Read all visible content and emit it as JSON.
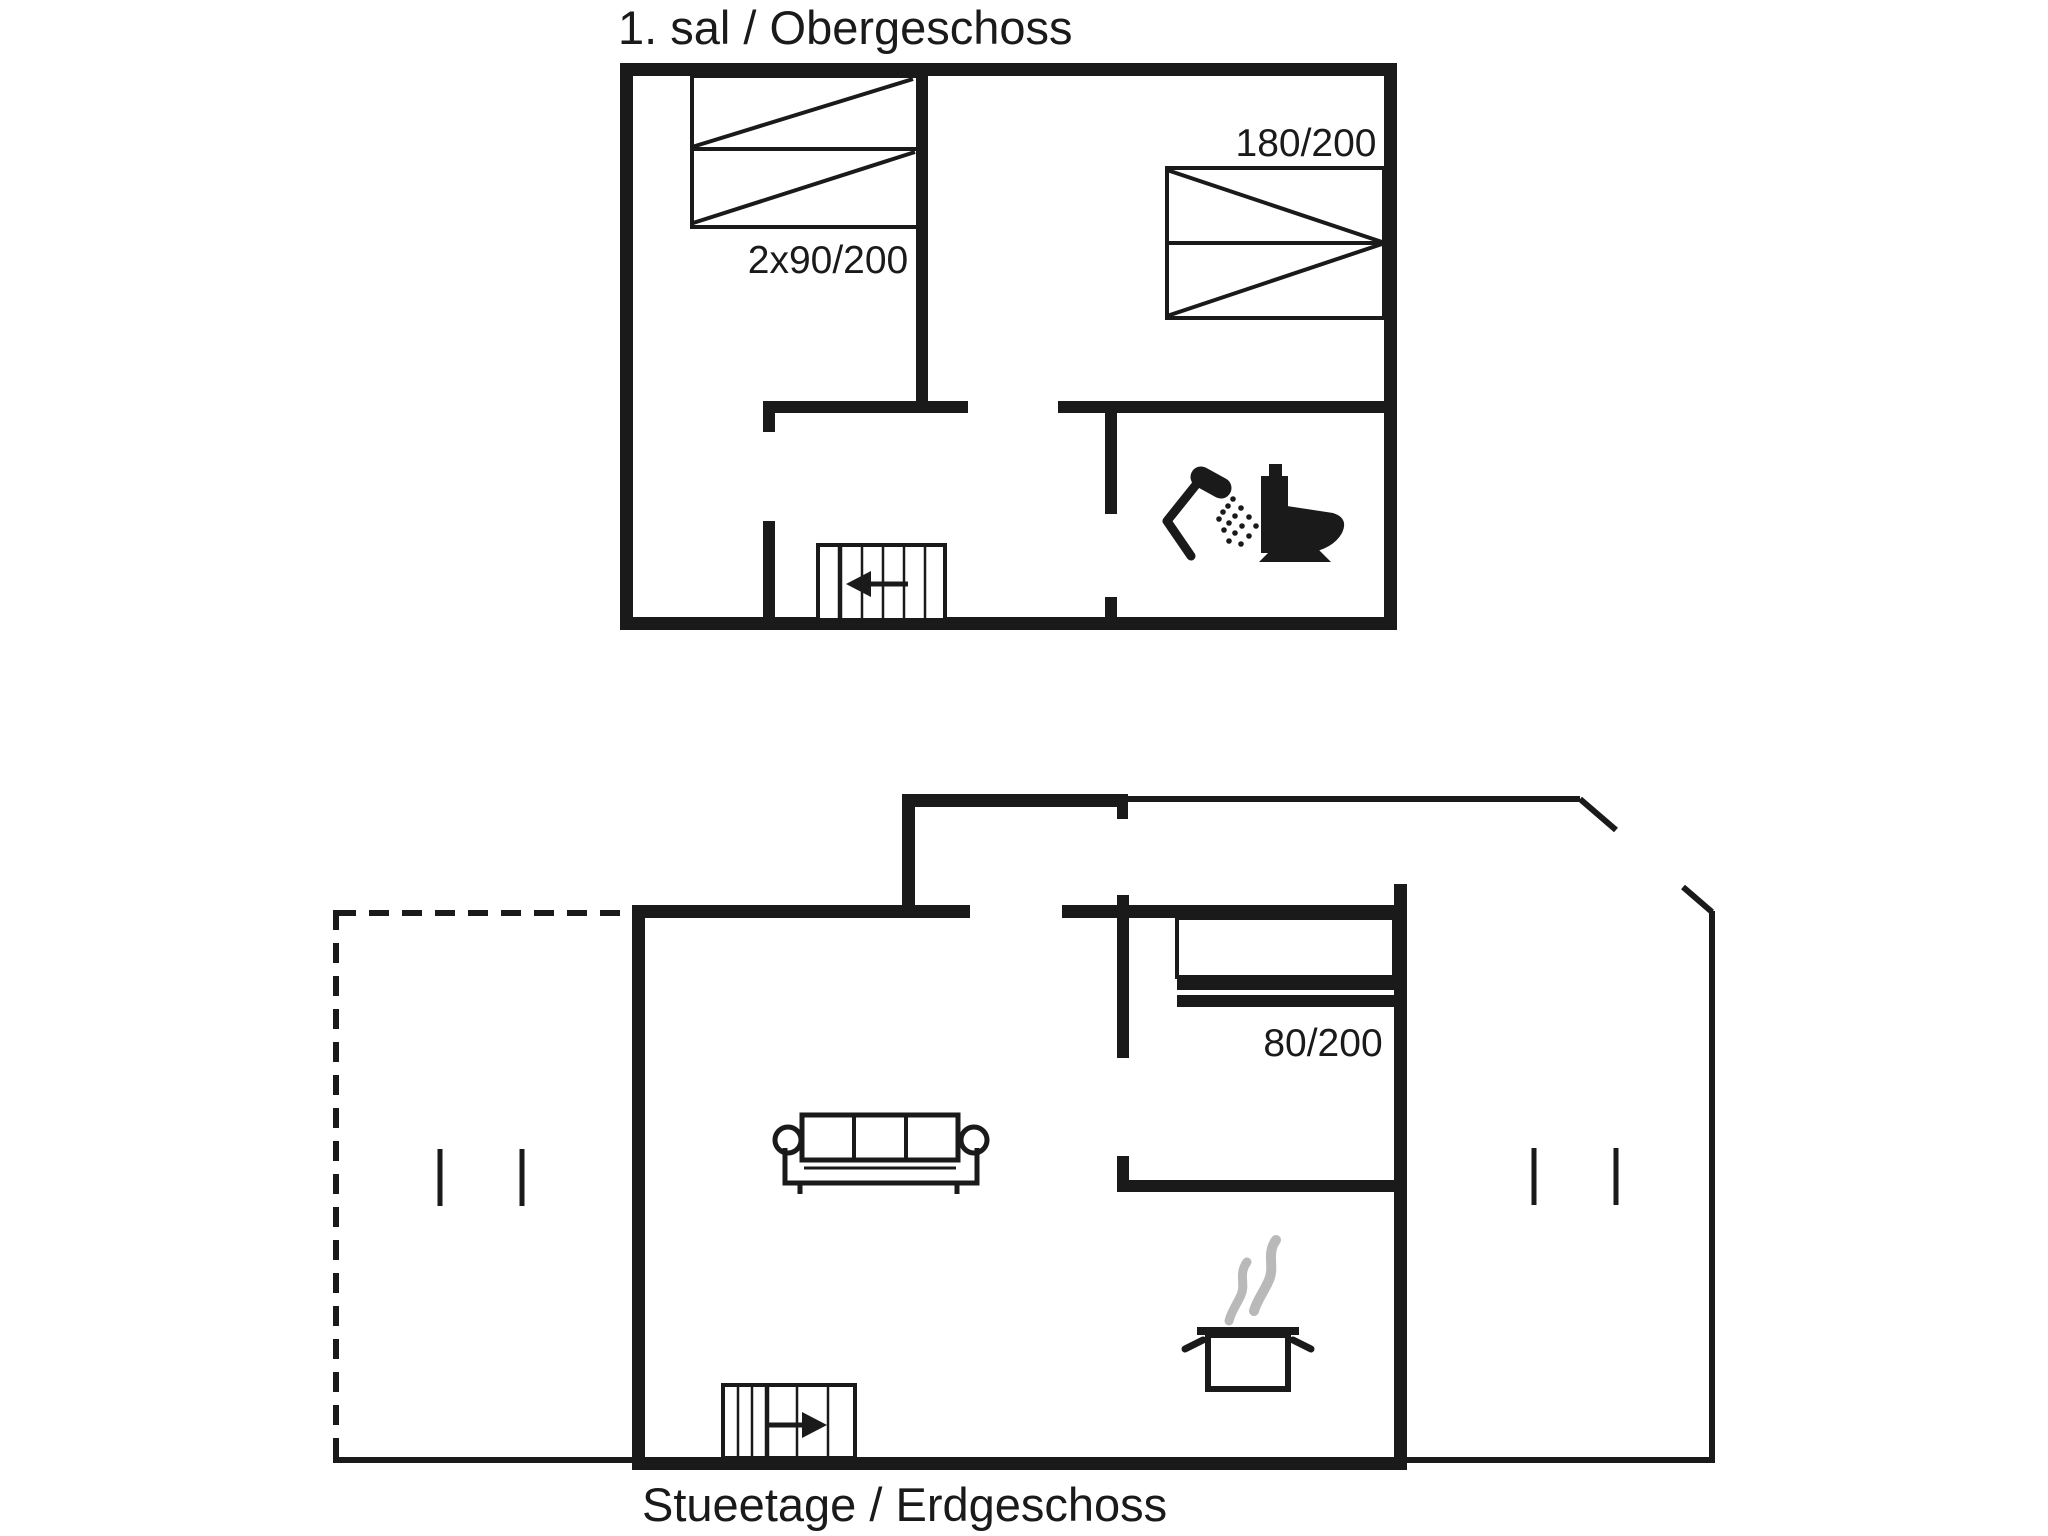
{
  "colors": {
    "ink": "#1a1a1a",
    "steam_gray": "#b9b9b9",
    "background": "#ffffff"
  },
  "upper_floor": {
    "title": "1. sal / Obergeschoss",
    "beds": [
      {
        "label": "2x90/200"
      },
      {
        "label": "180/200"
      }
    ],
    "icons": {
      "stairs": "staircase-arrow-left-icon",
      "shower": "shower-icon",
      "toilet": "toilet-icon"
    }
  },
  "ground_floor": {
    "title": "Stueetage / Erdgeschoss",
    "beds": [
      {
        "label": "80/200"
      }
    ],
    "icons": {
      "stairs": "staircase-arrow-right-icon",
      "sofa": "sofa-icon",
      "stove": "steaming-pot-icon"
    }
  }
}
